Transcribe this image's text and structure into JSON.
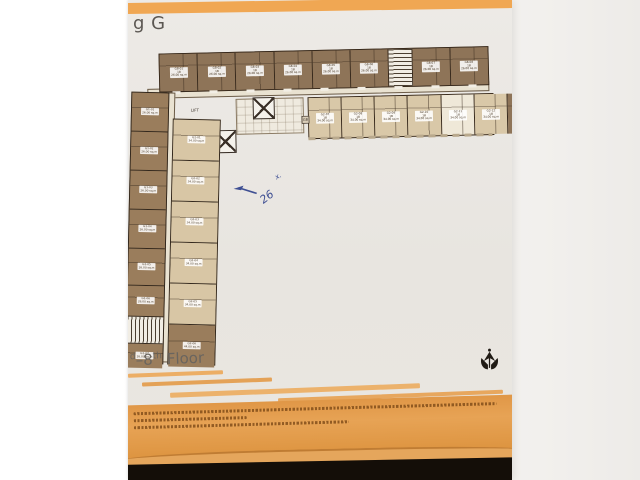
{
  "sheet": {
    "title_fragment": "g G",
    "floor_label": {
      "pre": "d",
      "range": "–8",
      "sup": "th",
      "word": "Floor"
    }
  },
  "plan": {
    "lift_label": "LIFT",
    "gb_label": "GB",
    "annotation": {
      "number": "26",
      "tick": "x."
    },
    "top_row_units": [
      {
        "no": "G8-01",
        "type": "1B",
        "area": "26.00 sq.m",
        "kind": "brown",
        "w": "11.6%"
      },
      {
        "no": "G8-02",
        "type": "1B",
        "area": "26.00 sq.m",
        "kind": "brown",
        "w": "11.6%"
      },
      {
        "no": "G8-03",
        "type": "1B",
        "area": "26.00 sq.m",
        "kind": "brown",
        "w": "11.6%"
      },
      {
        "no": "G8-04",
        "type": "1B",
        "area": "26.00 sq.m",
        "kind": "brown",
        "w": "11.6%"
      },
      {
        "no": "G8-05",
        "type": "1B",
        "area": "26.00 sq.m",
        "kind": "brown",
        "w": "11.6%"
      },
      {
        "no": "G8-06",
        "type": "1B",
        "area": "26.00 sq.m",
        "kind": "brown",
        "w": "11.6%"
      },
      {
        "kind": "stair",
        "w": "7%"
      },
      {
        "no": "G8-07",
        "type": "1B",
        "area": "26.00 sq.m",
        "kind": "brown",
        "w": "11.6%"
      },
      {
        "no": "G8-08",
        "type": "1B",
        "area": "26.00 sq.m",
        "kind": "brown",
        "w": "11.6%"
      }
    ],
    "mid_row_units": [
      {
        "no": "G2-07",
        "type": "1B",
        "area": "34.00 sq.m",
        "kind": "beige",
        "w": "12.5%"
      },
      {
        "no": "G2-08",
        "type": "1B",
        "area": "34.00 sq.m",
        "kind": "beige",
        "w": "12.5%"
      },
      {
        "no": "G2-09",
        "type": "1B",
        "area": "34.00 sq.m",
        "kind": "beige",
        "w": "12.5%"
      },
      {
        "no": "G2-10",
        "type": "1B",
        "area": "34.00 sq.m",
        "kind": "beige",
        "w": "12.5%"
      },
      {
        "no": "G2-11",
        "type": "1B",
        "area": "34.00 sq.m",
        "kind": "cream",
        "w": "12.5%"
      },
      {
        "no": "G2-12",
        "type": "1B",
        "area": "34.00 sq.m",
        "kind": "beige",
        "w": "12.5%"
      },
      {
        "no": "G2-13",
        "type": "1B",
        "area": "34.00 sq.m",
        "kind": "brown",
        "w": "12.5%"
      },
      {
        "no": "G2-14",
        "type": "1B",
        "area": "34.00 sq.m",
        "kind": "brown",
        "w": "12.5%"
      }
    ],
    "wing_left_units": [
      {
        "no": "G1-01",
        "area": "26.00 sq.m",
        "kind": "brown",
        "h": "38px"
      },
      {
        "no": "G1-02",
        "area": "26.00 sq.m",
        "kind": "brown",
        "h": "38px"
      },
      {
        "no": "G1-03",
        "area": "26.00 sq.m",
        "kind": "brown",
        "h": "38px"
      },
      {
        "no": "G1-04",
        "area": "26.00 sq.m",
        "kind": "brown",
        "h": "38px"
      },
      {
        "no": "G1-05",
        "area": "26.00 sq.m",
        "kind": "brown",
        "h": "36px"
      },
      {
        "no": "G1-06",
        "area": "26.00 sq.m",
        "kind": "brown",
        "h": "30px"
      },
      {
        "kind": "stairv",
        "h": "26px"
      },
      {
        "no": "G1-07",
        "area": "26.00 sq.m",
        "kind": "brown",
        "h": "24px"
      }
    ],
    "wing_right_units": [
      {
        "no": "G2-01",
        "area": "34.00 sq.m",
        "kind": "beige",
        "h": "40px"
      },
      {
        "no": "G2-02",
        "area": "34.00 sq.m",
        "kind": "beige",
        "h": "40px"
      },
      {
        "no": "G2-03",
        "area": "34.00 sq.m",
        "kind": "beige",
        "h": "40px"
      },
      {
        "no": "G2-04",
        "area": "34.00 sq.m",
        "kind": "beige",
        "h": "40px"
      },
      {
        "no": "G2-05",
        "area": "34.00 sq.m",
        "kind": "beige",
        "h": "40px"
      },
      {
        "no": "G2-06",
        "area": "44.00 sq.m",
        "kind": "brown",
        "h": "42px"
      }
    ]
  },
  "colors": {
    "accent_orange": "#f0a753",
    "footer_orange": "#e09747",
    "unit_brown": "#8e7458",
    "unit_beige": "#d9c8a8",
    "wall": "#37291c",
    "pen_blue": "#3f4f93"
  }
}
